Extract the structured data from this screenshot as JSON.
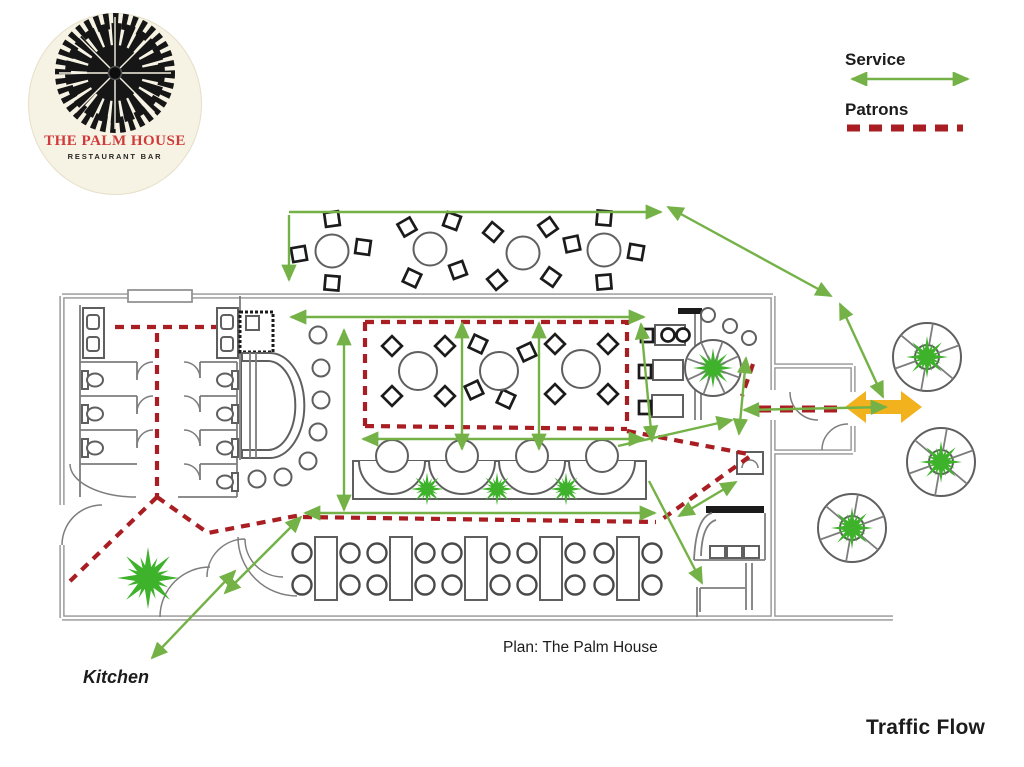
{
  "logo": {
    "name": "THE PALM HOUSE",
    "subtitle": "RESTAURANT BAR"
  },
  "legend": {
    "service": "Service",
    "patrons": "Patrons"
  },
  "labels": {
    "kitchen": "Kitchen",
    "plan_caption": "Plan: The Palm House",
    "title": "Traffic Flow"
  },
  "flows": {
    "service": {
      "color": "#74b247",
      "style": "solid double-headed green arrows"
    },
    "patrons": {
      "color": "#a91e22",
      "style": "red dashed paths"
    },
    "entrance": {
      "color": "#f2b21d",
      "style": "thick gold double-headed arrow at main entrance"
    }
  },
  "colors": {
    "service_green": "#74b247",
    "patron_red": "#a91e22",
    "entrance_gold": "#f2b21d",
    "wall_gray": "#949494",
    "furniture_gray": "#5f5f5f",
    "chair_black": "#1b1b1b",
    "plant_green": "#3eb22b",
    "logo_cream": "#f7f3e4",
    "logo_red": "#cf3a3a"
  }
}
